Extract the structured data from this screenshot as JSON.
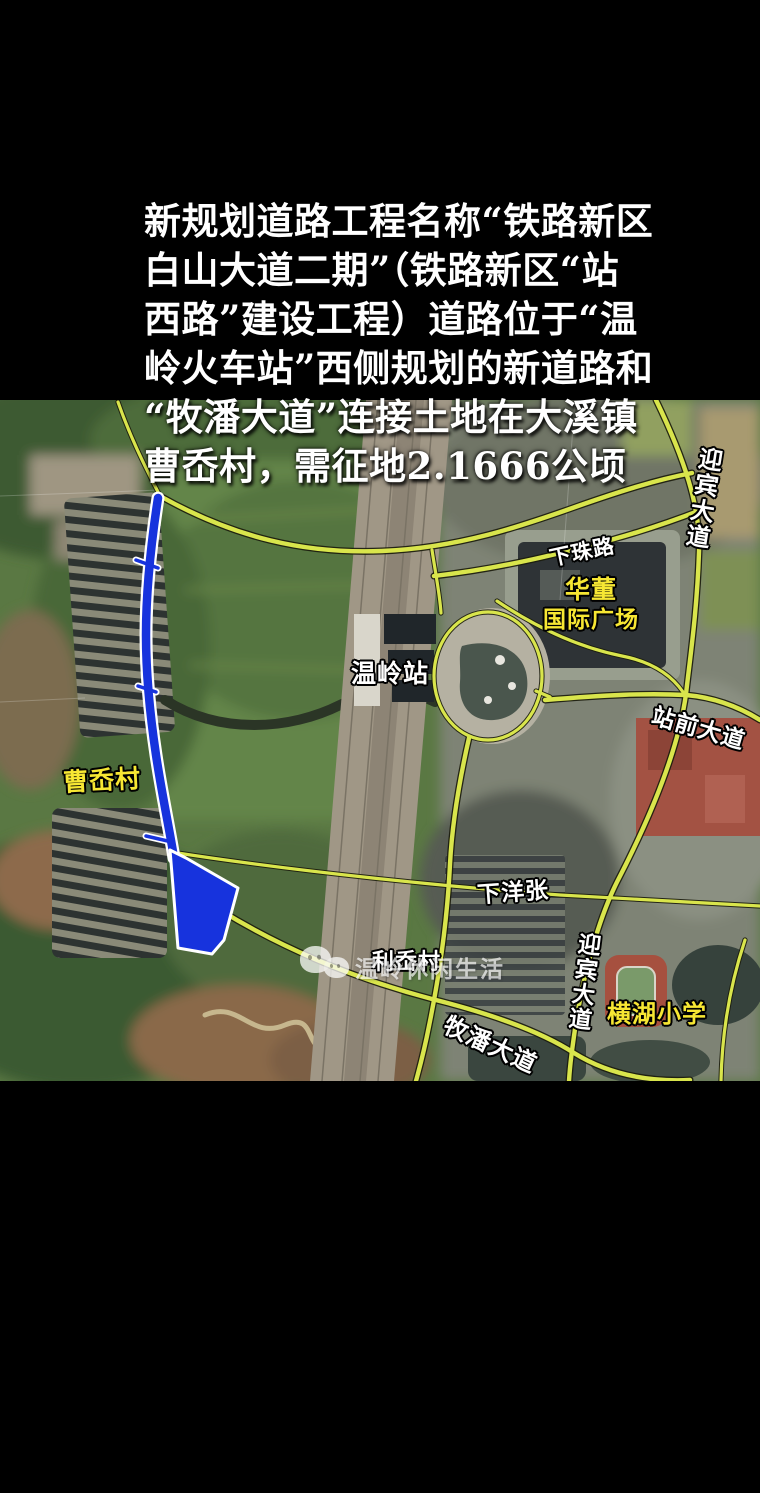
{
  "overlay_text": {
    "lines": [
      "新规划道路工程名称“铁路新区",
      "白山大道二期”（铁路新区“站",
      "西路”建设工程）道路位于“温",
      "岭火车站”西侧规划的新道路和",
      "“牧潘大道”连接土地在大溪镇",
      "曹岙村，需征地2.1666公顷"
    ]
  },
  "map": {
    "labels": {
      "yingbin_top": {
        "text": "迎宾大道",
        "color": "#ffffff"
      },
      "xiazhu_road": {
        "text": "下珠路",
        "color": "#ffffff"
      },
      "huadong_line1": {
        "text": "华董",
        "color": "#f7e733"
      },
      "huadong_line2": {
        "text": "国际广场",
        "color": "#f7e733"
      },
      "wenling_station": {
        "text": "温岭站",
        "color": "#ffffff"
      },
      "zhanqian_avenue": {
        "text": "站前大道",
        "color": "#ffffff"
      },
      "caoao_village": {
        "text": "曹岙村",
        "color": "#f7e733"
      },
      "liao_village": {
        "text": "利岙村",
        "color": "#ffffff"
      },
      "xiayangzhang": {
        "text": "下洋张",
        "color": "#ffffff"
      },
      "yingbin_bottom": {
        "text": "迎宾大道",
        "color": "#ffffff"
      },
      "henghu_school": {
        "text": "横湖小学",
        "color": "#f7e733"
      },
      "mupan_avenue": {
        "text": "牧潘大道",
        "color": "#ffffff"
      }
    },
    "watermark": {
      "text": "温岭休闲生活"
    },
    "colors": {
      "road_yellow": "#d9e54c",
      "planned_road_blue": "#1733dd",
      "label_yellow": "#f7e733",
      "label_white": "#ffffff",
      "letterbox": "#000000"
    }
  }
}
